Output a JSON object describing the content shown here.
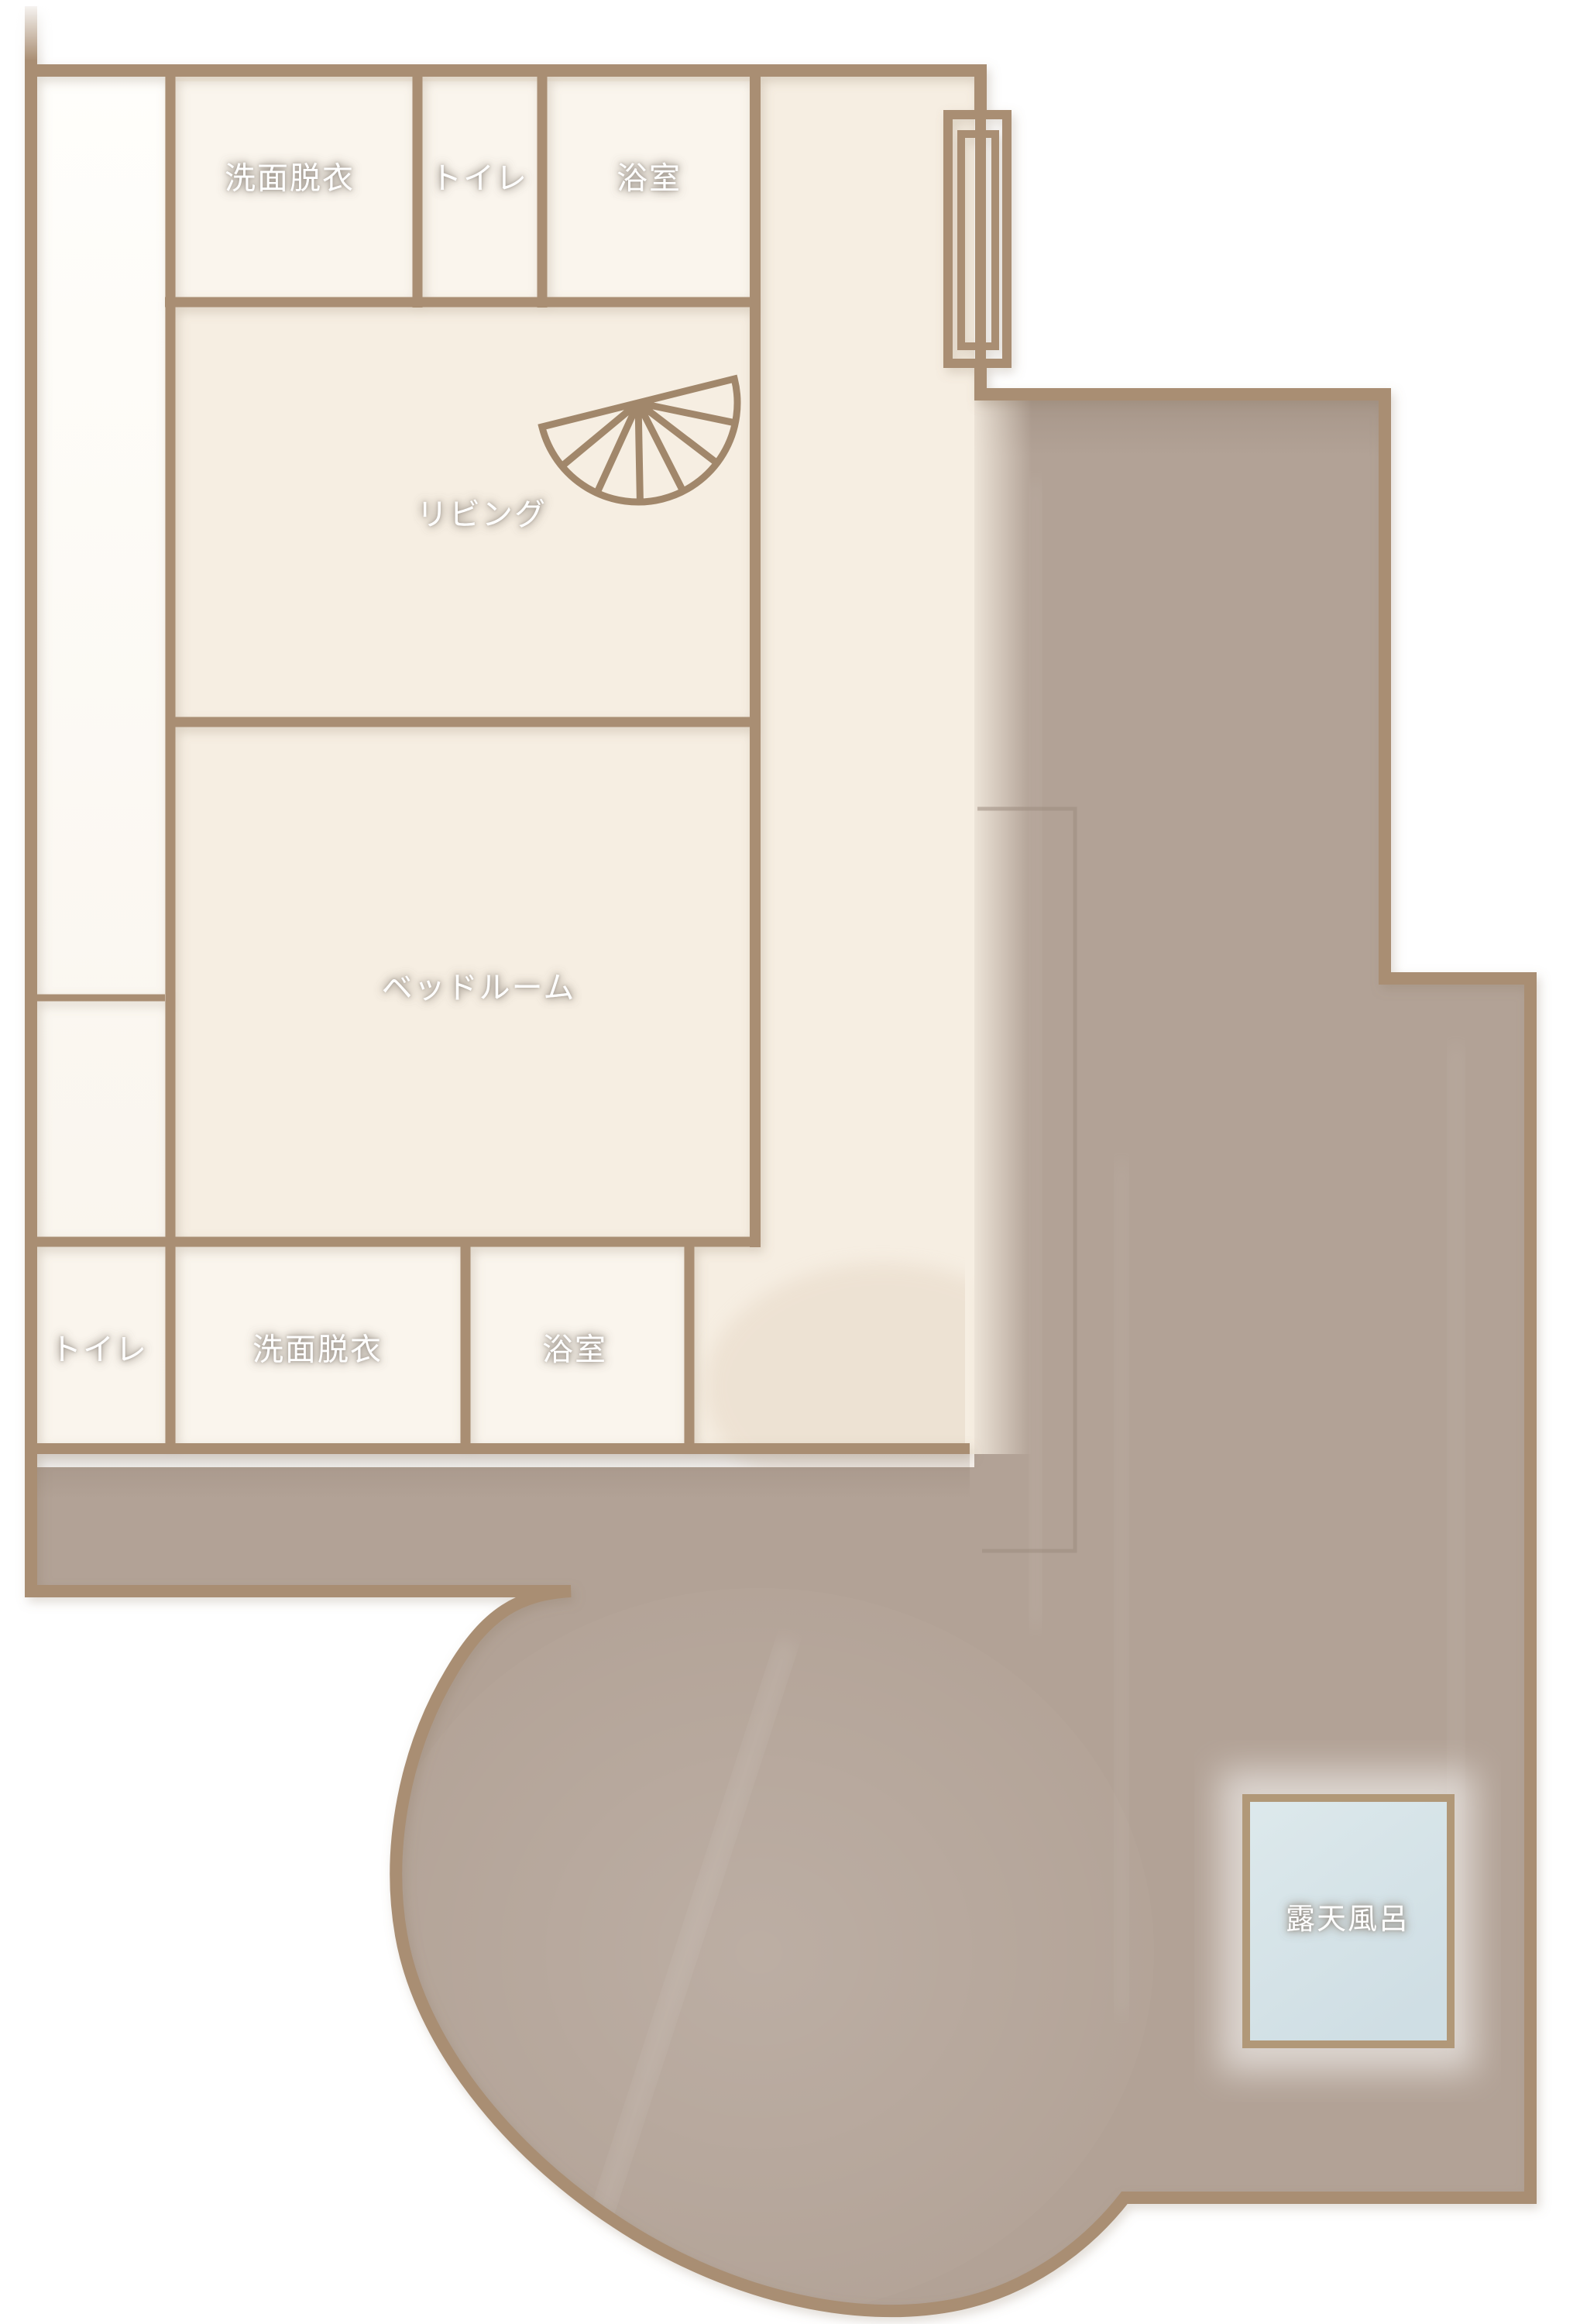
{
  "floorplan": {
    "rooms": {
      "washroom_top": {
        "label": "洗面脱衣"
      },
      "toilet_top": {
        "label": "トイレ"
      },
      "bath_top": {
        "label": "浴室"
      },
      "living": {
        "label": "リビング"
      },
      "bedroom": {
        "label": "ベッドルーム"
      },
      "toilet_bottom": {
        "label": "トイレ"
      },
      "washroom_bottom": {
        "label": "洗面脱衣"
      },
      "bath_bottom": {
        "label": "浴室"
      },
      "open_air_bath": {
        "label": "露天風呂"
      }
    },
    "icons": {
      "fan": "folding-fan-icon",
      "window": "window-icon"
    },
    "colors": {
      "wall": "#a98e73",
      "floor_cream": "#f6eee2",
      "room_pale": "#faf5ed",
      "corridor_white": "#fdfcf9",
      "terrace_taupe": "#b2a296",
      "deck_taupe": "#b3a498",
      "bath_water_blue": "#d5e2e7",
      "bath_border": "#b19878",
      "label_text": "#ffffff"
    }
  }
}
